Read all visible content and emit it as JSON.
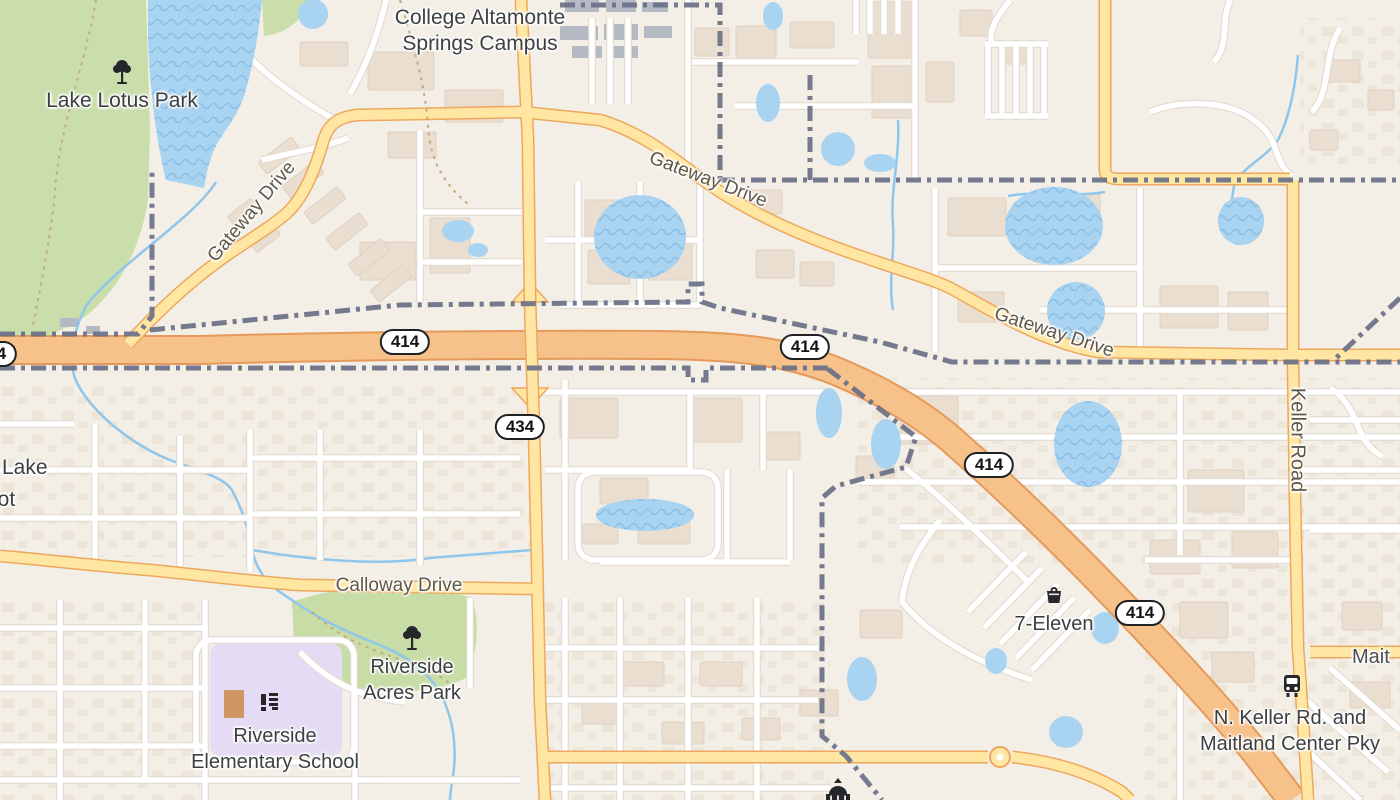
{
  "map": {
    "pois": {
      "campus": {
        "lines": [
          "Seminole State",
          "College Altamonte",
          "Springs Campus"
        ]
      },
      "lake_lotus_park": {
        "label": "Lake Lotus Park"
      },
      "riverside_acres_park": {
        "lines": [
          "Riverside",
          "Acres Park"
        ]
      },
      "riverside_elementary_school": {
        "lines": [
          "Riverside",
          "Elementary School"
        ]
      },
      "seven_eleven": {
        "label": "7-Eleven"
      },
      "transit_stop": {
        "lines": [
          "N. Keller Rd. and",
          "Maitland Center Pky"
        ]
      },
      "lake_lot_partial": {
        "lines": [
          "Lake",
          "Lot"
        ]
      },
      "maitland_partial": {
        "label": "Mait"
      }
    },
    "roads": {
      "gateway_drive": "Gateway Drive",
      "keller_road": "Keller Road",
      "calloway_drive": "Calloway Drive"
    },
    "shields": {
      "sr_414": "414",
      "sr_434": "434"
    },
    "colors": {
      "highway": "#F6C289",
      "major_road": "#FFE7A3",
      "water": "#A8D3F1",
      "park": "#CBDFAD",
      "boundary": "#6B7187",
      "school_area": "#E6DBF4"
    }
  }
}
